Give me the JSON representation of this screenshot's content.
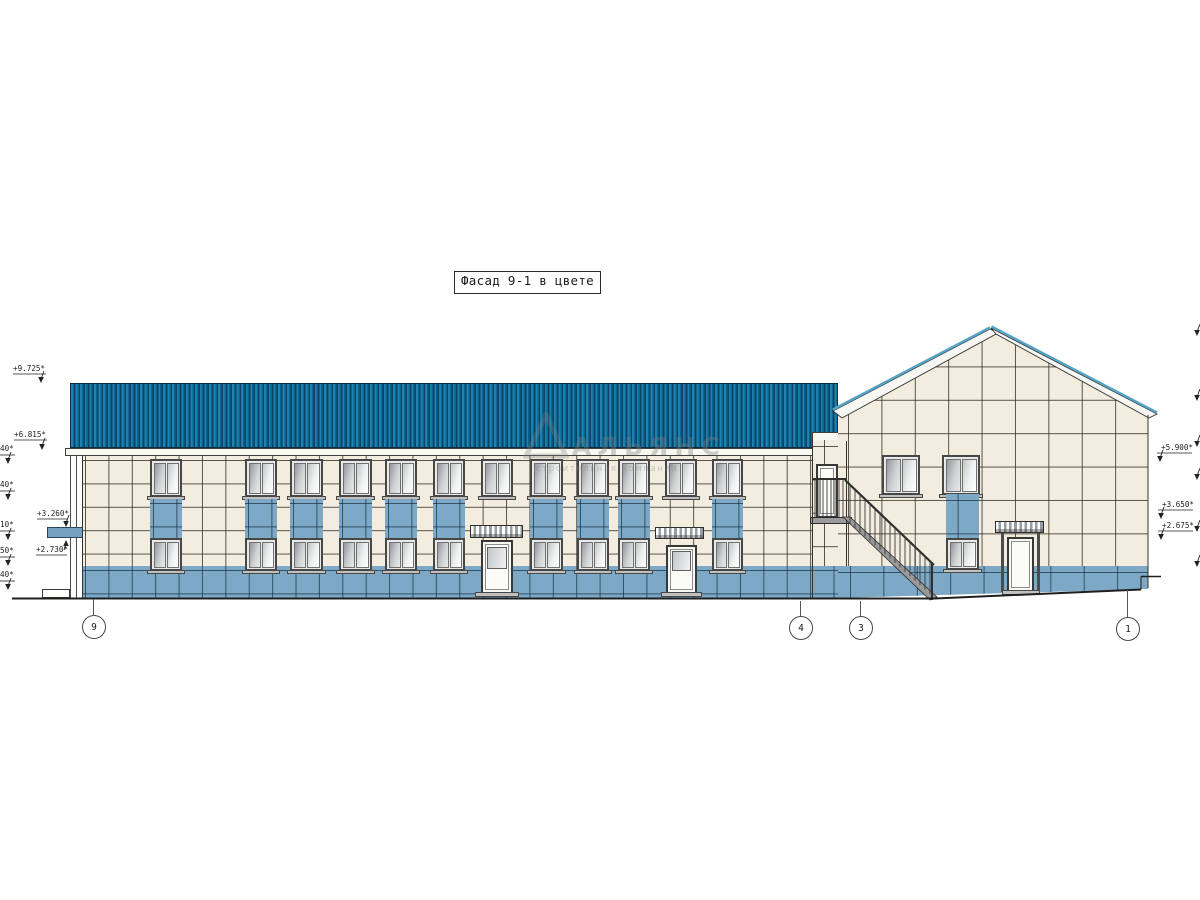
{
  "title": "Фасад 9-1 в цвете",
  "watermark": {
    "logo": "triangle-icon",
    "name": "АЛЬЯНС",
    "tagline": "строительная компания"
  },
  "colors": {
    "roof_blue": "#1a83b2",
    "roof_stripe_dark": "#0a4263",
    "tile_cream": "#f2edde",
    "tile_blue": "#7da9c6",
    "grout": "#322e24",
    "fascia_white": "#f8f8f3",
    "frame_gray": "#474747"
  },
  "elevation_marks": {
    "left": [
      {
        "label": "+9.725*",
        "lx": 13,
        "ly": 364,
        "u": [
          13,
          46,
          374
        ],
        "tip": [
          41,
          383
        ],
        "dir": "down"
      },
      {
        "label": "+6.815*",
        "lx": 14,
        "ly": 430,
        "u": [
          14,
          47,
          440
        ],
        "tip": [
          42,
          450
        ],
        "dir": "down"
      },
      {
        "label": "+3.260*",
        "lx": 37,
        "ly": 509,
        "u": [
          37,
          68,
          519
        ],
        "tip": [
          66,
          527
        ],
        "dir": "down"
      },
      {
        "label": "+2.730*",
        "lx": 36,
        "ly": 545,
        "u": [
          36,
          67,
          555
        ],
        "tip": [
          66,
          540
        ],
        "dir": "up"
      }
    ],
    "left_clipped": [
      {
        "label": "40*",
        "lx": 0,
        "ly": 444,
        "u": [
          0,
          15,
          455
        ],
        "tip": [
          8,
          464
        ],
        "dir": "down"
      },
      {
        "label": "40*",
        "lx": 0,
        "ly": 480,
        "u": [
          0,
          15,
          491
        ],
        "tip": [
          8,
          500
        ],
        "dir": "down"
      },
      {
        "label": "10*",
        "lx": 0,
        "ly": 520,
        "u": [
          0,
          15,
          531
        ],
        "tip": [
          8,
          540
        ],
        "dir": "down"
      },
      {
        "label": "50*",
        "lx": 0,
        "ly": 546,
        "u": [
          0,
          15,
          557
        ],
        "tip": [
          8,
          566
        ],
        "dir": "down"
      },
      {
        "label": "40*",
        "lx": 0,
        "ly": 570,
        "u": [
          0,
          15,
          581
        ],
        "tip": [
          8,
          590
        ],
        "dir": "down"
      }
    ],
    "right": [
      {
        "label": "+5.900*",
        "lx": 1161,
        "ly": 443,
        "u": [
          1157,
          1192,
          453
        ],
        "tip": [
          1160,
          462
        ],
        "dir": "down"
      },
      {
        "label": "+3.650*",
        "lx": 1162,
        "ly": 500,
        "u": [
          1158,
          1193,
          510
        ],
        "tip": [
          1161,
          519
        ],
        "dir": "down"
      },
      {
        "label": "+2.675*",
        "lx": 1162,
        "ly": 521,
        "u": [
          1158,
          1193,
          531
        ],
        "tip": [
          1161,
          540
        ],
        "dir": "down"
      }
    ],
    "right_clipped": [
      {
        "tip": [
          1197,
          336
        ]
      },
      {
        "tip": [
          1197,
          401
        ]
      },
      {
        "tip": [
          1197,
          447
        ]
      },
      {
        "tip": [
          1197,
          480
        ]
      },
      {
        "tip": [
          1197,
          532
        ]
      },
      {
        "tip": [
          1197,
          567
        ]
      }
    ]
  },
  "axis_bubbles": [
    {
      "label": "9",
      "cx": 93,
      "cy": 626,
      "leader_top": 599
    },
    {
      "label": "4",
      "cx": 800,
      "cy": 627,
      "leader_top": 601
    },
    {
      "label": "3",
      "cx": 860,
      "cy": 627,
      "leader_top": 601
    },
    {
      "label": "1",
      "cx": 1127,
      "cy": 628,
      "leader_top": 590
    }
  ],
  "facade": {
    "bays": [
      {
        "x": 150,
        "w": 32,
        "type": "window"
      },
      {
        "x": 245,
        "w": 32,
        "type": "window"
      },
      {
        "x": 290,
        "w": 33,
        "type": "window"
      },
      {
        "x": 339,
        "w": 33,
        "type": "window"
      },
      {
        "x": 385,
        "w": 32,
        "type": "window"
      },
      {
        "x": 433,
        "w": 32,
        "type": "window"
      },
      {
        "x": 481,
        "w": 32,
        "type": "door"
      },
      {
        "x": 530,
        "w": 33,
        "type": "window"
      },
      {
        "x": 577,
        "w": 32,
        "type": "window"
      },
      {
        "x": 618,
        "w": 32,
        "type": "window"
      },
      {
        "x": 665,
        "w": 32,
        "type": "door"
      },
      {
        "x": 712,
        "w": 31,
        "type": "window"
      }
    ],
    "doors": [
      {
        "door": [
          481,
          540,
          32,
          54
        ],
        "canopy": [
          470,
          525,
          53,
          13
        ],
        "step": [
          475,
          592,
          44,
          5
        ]
      },
      {
        "door": [
          666,
          545,
          31,
          49
        ],
        "canopy": [
          655,
          527,
          49,
          12
        ],
        "step": [
          661,
          592,
          41,
          5
        ]
      }
    ]
  },
  "right_section": {
    "upper_windows": [
      [
        882,
        455,
        38,
        40
      ],
      [
        942,
        455,
        38,
        40
      ]
    ],
    "lower_window": [
      946,
      538,
      33,
      32
    ],
    "lower_spandrel": [
      946,
      494,
      33,
      44
    ],
    "stair_door": [
      816,
      464,
      22,
      54
    ],
    "entry": {
      "canopy": [
        995,
        521,
        49,
        12
      ],
      "posts": [
        1001,
        1037
      ],
      "door": [
        1007,
        537,
        27,
        55
      ],
      "step": [
        1002,
        590,
        38,
        5
      ]
    }
  }
}
